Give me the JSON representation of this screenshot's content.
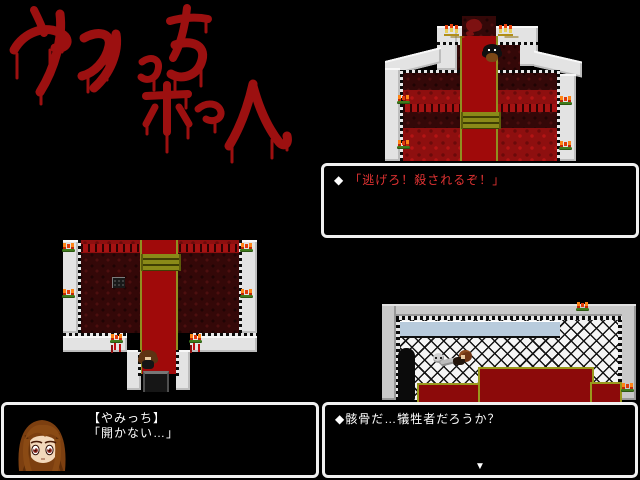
{
  "title_panel": {
    "text": "やみっちホーム",
    "style": "hand-drawn blood lettering",
    "color": "#9c1010"
  },
  "dialog_top_right": {
    "bullet": "◆",
    "text": "「逃げろ！殺されるぞ！」",
    "text_color": "#e23333"
  },
  "dialog_bottom_left": {
    "speaker": "【やみっち】",
    "text": "「開かない…」",
    "text_color": "#ffffff",
    "portrait": "yamicchi-face-portrait"
  },
  "dialog_bottom_right": {
    "bullet": "◆",
    "text": "骸骨だ…犠牲者だろうか？",
    "text_color": "#ffffff",
    "continue_indicator": "▼"
  },
  "icons": {
    "diamond_bullet": "◆",
    "continue_arrow": "▼",
    "candelabra": "gold candelabra with red flames",
    "sconce": "green wall sconce with orange flames"
  },
  "colors": {
    "background": "#000000",
    "blood_title": "#9c1010",
    "dialog_red_text": "#e23333",
    "dialog_border": "#f0f0f0",
    "carpet_red": "#a00a0a",
    "carpet_border_olive": "#8f8f1f",
    "floor_dark_red": "#340808",
    "pew_red": "#8e0f0f",
    "wall_white": "#e3e3e3",
    "wall_gray": "#c9c9c9",
    "lattice_white": "#f5f5f5",
    "window_blue": "#b8cbdc",
    "platform_red": "#8c0a0a",
    "flame_orange": "#ff8516"
  }
}
